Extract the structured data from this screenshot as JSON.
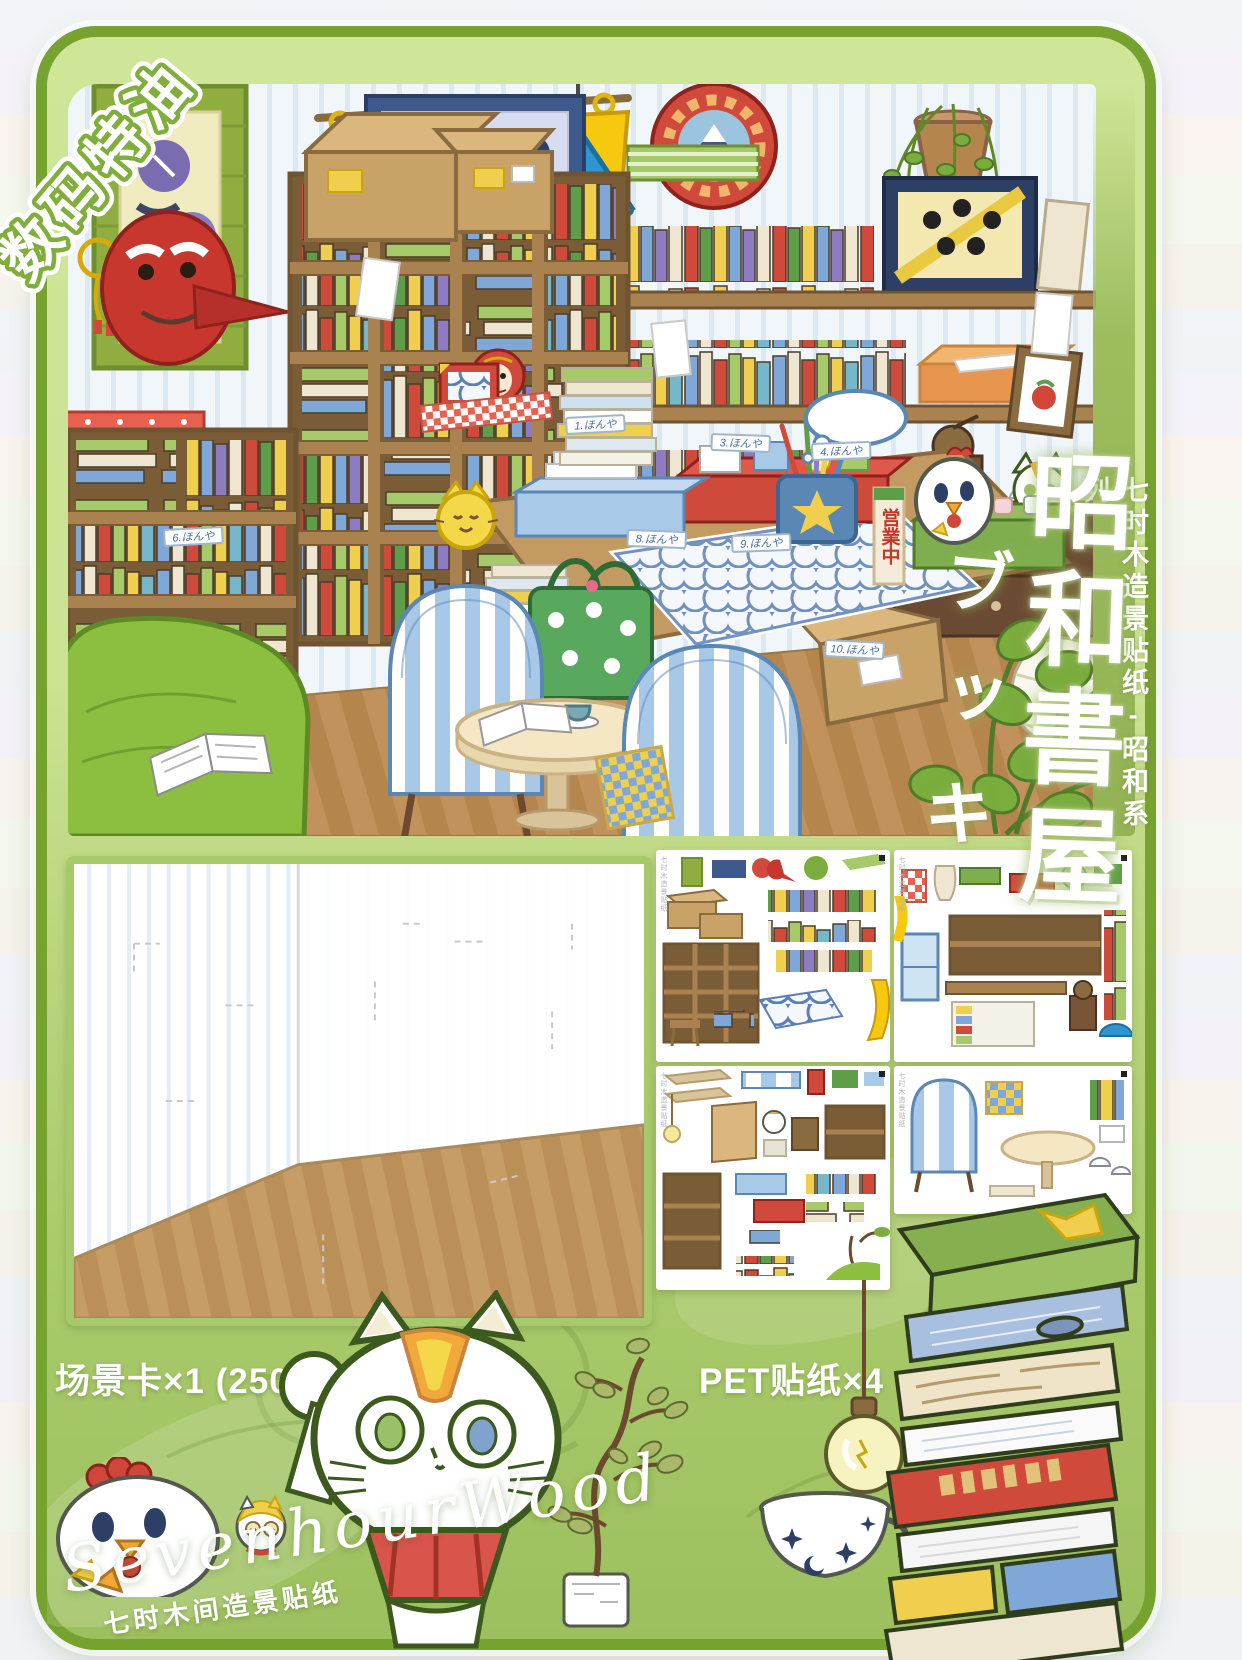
{
  "corner_ribbon": {
    "label": "数码特油"
  },
  "side_banner": {
    "label": "七时木造景贴纸-昭和系列"
  },
  "title": {
    "main": "昭和書屋",
    "kana": "ブッキ"
  },
  "scene": {
    "open_sign": "営業中",
    "shelf_tags": [
      "1.ほんや",
      "2.ほんや",
      "3.ほんや",
      "4.ほんや",
      "5.ほんや",
      "6.ほんや",
      "7.ほんや",
      "8.ほんや",
      "9.ほんや",
      "10.ほんや"
    ]
  },
  "sheets": {
    "edge_label": "七时木造景贴纸"
  },
  "specs": {
    "scene_card_label": "场景卡×1 (250×178 MM)",
    "sticker_label": "PET贴纸×4"
  },
  "brand": {
    "script": "SevenhourWood",
    "caption": "七时木间造景贴纸"
  },
  "colors": {
    "frame_green": "#76a230",
    "frame_fill": "#cbe293",
    "accent_red": "#d0473a",
    "curtain_yellow": "#f6c80e",
    "lamp_blue": "#2f96cf",
    "wood_brown": "#a9824f"
  }
}
